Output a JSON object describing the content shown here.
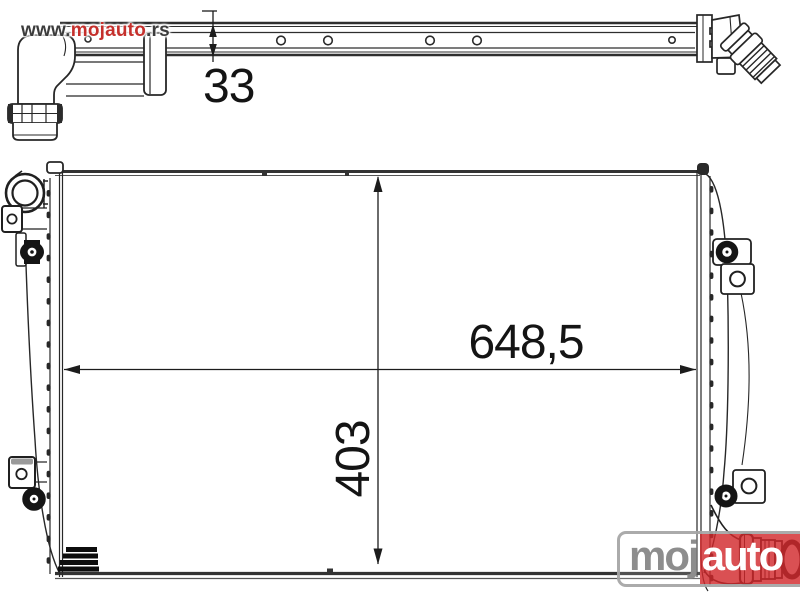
{
  "watermark": {
    "prefix": "www.",
    "brand": "mojauto",
    "suffix": ".rs"
  },
  "dimensions": {
    "depth": "33",
    "width": "648,5",
    "height": "403"
  },
  "logo": {
    "gray_text": "moj",
    "red_text": "auto"
  },
  "drawing": {
    "subject": "radiator-technical-drawing",
    "views": [
      "side-view-top",
      "front-view-main"
    ]
  },
  "colors": {
    "drawing_line": "#272727",
    "brand_red": "#d01f22",
    "watermark_red": "#c5302c",
    "watermark_gray": "#3c3c3c",
    "logo_gray": "#8d8d8d",
    "logo_border": "#a4a4a4"
  }
}
